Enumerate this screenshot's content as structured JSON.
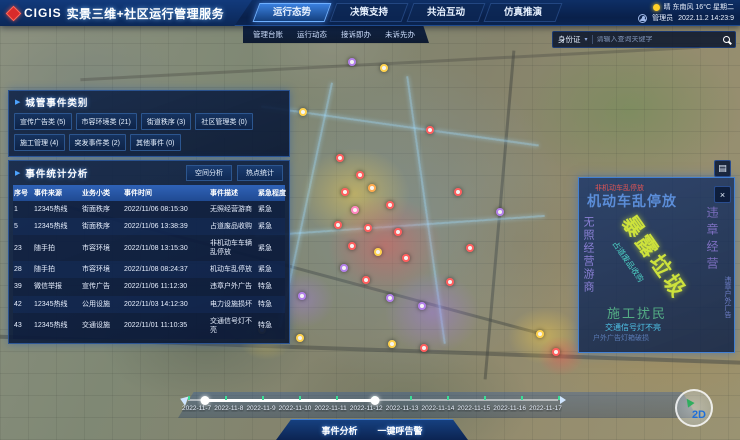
{
  "colors": {
    "accent": "#2f6fd0",
    "panel_bg": "#0a1e44",
    "table_header": "#2857a8",
    "highlight": "#4da3ff",
    "logo_red": "#d92b2b"
  },
  "header": {
    "logo_text": "CIGIS",
    "title": "实景三维+社区运行管理服务",
    "tabs": [
      {
        "label": "运行态势",
        "active": true
      },
      {
        "label": "决策支持",
        "active": false
      },
      {
        "label": "共治互动",
        "active": false
      },
      {
        "label": "仿真推演",
        "active": false
      }
    ],
    "weather": {
      "icon": "sun-icon",
      "text": "晴 东南风 16°C 星期二"
    },
    "user": {
      "icon": "user-icon",
      "name": "管理员",
      "datetime": "2022.11.2 14:23:9"
    }
  },
  "subnav": {
    "items": [
      "管理台账",
      "运行动态",
      "接诉即办",
      "未诉先办"
    ]
  },
  "search": {
    "category": "身份证",
    "chevron": "▾",
    "placeholder": "请输入查询关键字",
    "icon": "search-icon"
  },
  "category_panel": {
    "title": "城管事件类别",
    "items": [
      "宣传广告类 (5)",
      "市容环境类 (21)",
      "街道秩序 (3)",
      "社区管理类 (0)",
      "施工管理 (4)",
      "突发事件类 (2)",
      "其他事件 (0)"
    ]
  },
  "stats_panel": {
    "title": "事件统计分析",
    "actions": [
      "空间分析",
      "热点统计"
    ],
    "columns": [
      "序号",
      "事件来源",
      "业务小类",
      "事件时间",
      "事件描述",
      "紧急程度"
    ],
    "rows": [
      [
        "1",
        "12345热线",
        "街面秩序",
        "2022/11/06 08:15:30",
        "无照经营游商",
        "紧急"
      ],
      [
        "5",
        "12345热线",
        "街面秩序",
        "2022/11/06 13:38:39",
        "占道废品收购",
        "紧急"
      ],
      [
        "23",
        "随手拍",
        "市容环境",
        "2022/11/08 13:15:30",
        "非机动车车辆乱停放",
        "紧急"
      ],
      [
        "28",
        "随手拍",
        "市容环境",
        "2022/11/08 08:24:37",
        "机动车乱停放",
        "紧急"
      ],
      [
        "39",
        "微信举报",
        "宣传广告",
        "2022/11/06 11:12:30",
        "违章户外广告",
        "特急"
      ],
      [
        "42",
        "12345热线",
        "公用设施",
        "2022/11/03 14:12:30",
        "电力设施损坏",
        "特急"
      ],
      [
        "43",
        "12345热线",
        "交通设施",
        "2022/11/01 11:10:35",
        "交通信号灯不亮",
        "特急"
      ]
    ]
  },
  "wordcloud": {
    "words": [
      "非机动车乱停放",
      "机动车乱停放",
      "无照经营游商",
      "占道废品收购",
      "暴露垃圾",
      "违章经营",
      "违章户外广告",
      "施工扰民",
      "交通信号灯不亮",
      "户外广告灯箱破损"
    ]
  },
  "timeline": {
    "dates": [
      "2022-11-7",
      "2022-11-8",
      "2022-11-9",
      "2022-11-10",
      "2022-11-11",
      "2022-11-12",
      "2022-11-13",
      "2022-11-14",
      "2022-11-15",
      "2022-11-16",
      "2022-11-17"
    ]
  },
  "footer": {
    "buttons": [
      "事件分析",
      "一键呼告警"
    ]
  },
  "map": {
    "compass_label": "2D",
    "markers": [
      {
        "x": 352,
        "y": 62,
        "color": "#b37feb"
      },
      {
        "x": 384,
        "y": 68,
        "color": "#ffd24d"
      },
      {
        "x": 303,
        "y": 112,
        "color": "#ffd24d"
      },
      {
        "x": 430,
        "y": 130,
        "color": "#ff5d5d"
      },
      {
        "x": 340,
        "y": 158,
        "color": "#ff5d5d"
      },
      {
        "x": 360,
        "y": 175,
        "color": "#ff5d5d"
      },
      {
        "x": 345,
        "y": 192,
        "color": "#ff5d5d"
      },
      {
        "x": 372,
        "y": 188,
        "color": "#ffa94d"
      },
      {
        "x": 390,
        "y": 205,
        "color": "#ff5d5d"
      },
      {
        "x": 355,
        "y": 210,
        "color": "#ff85c0"
      },
      {
        "x": 338,
        "y": 225,
        "color": "#ff5d5d"
      },
      {
        "x": 368,
        "y": 228,
        "color": "#ff5d5d"
      },
      {
        "x": 398,
        "y": 232,
        "color": "#ff5d5d"
      },
      {
        "x": 352,
        "y": 246,
        "color": "#ff5d5d"
      },
      {
        "x": 378,
        "y": 252,
        "color": "#ffd24d"
      },
      {
        "x": 406,
        "y": 258,
        "color": "#ff5d5d"
      },
      {
        "x": 344,
        "y": 268,
        "color": "#b37feb"
      },
      {
        "x": 366,
        "y": 280,
        "color": "#ff5d5d"
      },
      {
        "x": 302,
        "y": 296,
        "color": "#b37feb"
      },
      {
        "x": 390,
        "y": 298,
        "color": "#b37feb"
      },
      {
        "x": 422,
        "y": 306,
        "color": "#b37feb"
      },
      {
        "x": 450,
        "y": 282,
        "color": "#ff5d5d"
      },
      {
        "x": 470,
        "y": 248,
        "color": "#ff5d5d"
      },
      {
        "x": 500,
        "y": 212,
        "color": "#b37feb"
      },
      {
        "x": 458,
        "y": 192,
        "color": "#ff5d5d"
      },
      {
        "x": 262,
        "y": 330,
        "color": "#ffd24d"
      },
      {
        "x": 300,
        "y": 338,
        "color": "#ffd24d"
      },
      {
        "x": 392,
        "y": 344,
        "color": "#ffd24d"
      },
      {
        "x": 424,
        "y": 348,
        "color": "#ff5d5d"
      },
      {
        "x": 540,
        "y": 334,
        "color": "#ffd24d"
      },
      {
        "x": 556,
        "y": 352,
        "color": "#ff5d5d"
      }
    ]
  }
}
